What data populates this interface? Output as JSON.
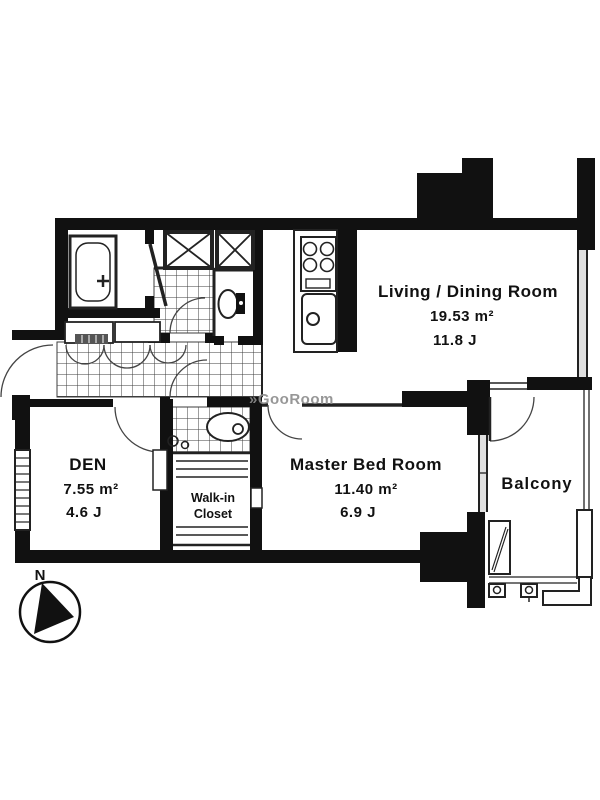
{
  "rooms": {
    "living": {
      "name": "Living / Dining Room",
      "area": "19.53 m²",
      "size_j": "11.8 J"
    },
    "den": {
      "name": "DEN",
      "area": "7.55 m²",
      "size_j": "4.6 J"
    },
    "master": {
      "name": "Master Bed Room",
      "area": "11.40 m²",
      "size_j": "6.9 J"
    },
    "walk_in_closet": {
      "line1": "Walk-in",
      "line2": "Closet"
    },
    "balcony": {
      "name": "Balcony"
    }
  },
  "compass": {
    "north_label": "N"
  },
  "watermark": {
    "text": "»GooRoom"
  },
  "colors": {
    "wall": "#111111",
    "line": "#222222",
    "tile_line": "#3d3d3d",
    "watermark": "#8c8c8c",
    "background": "#ffffff"
  }
}
